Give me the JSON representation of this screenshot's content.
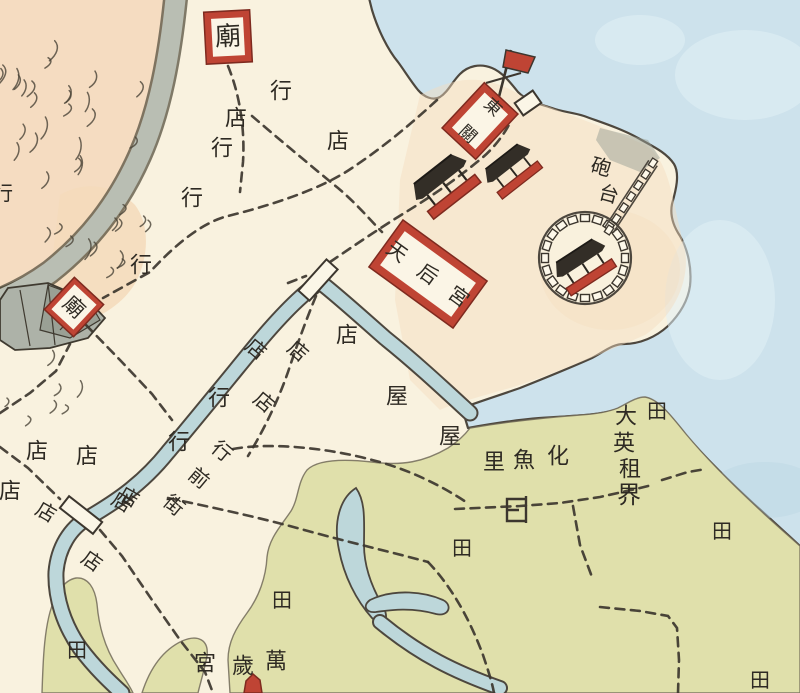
{
  "map": {
    "colors": {
      "paper": "#f9f2df",
      "sea": "#cde2ec",
      "sea_light": "#e2f0f5",
      "river": "#bdd7da",
      "field": "#e0e0ab",
      "hill": "#f5dcc1",
      "hill_soft": "#f3dcbe",
      "gray_band": "#b9beb3",
      "rock": "#adb2a8",
      "red": "#bf4434",
      "red_dark": "#7e2a1f",
      "ink": "#3c362e"
    },
    "place_names": {
      "british_concession": "大英租界",
      "village": "化魚里",
      "street": "行前街",
      "fort": "砲台",
      "tianhou_palace": "天后宮",
      "east_gate": "東關",
      "wansui_palace": "萬歲宮",
      "temple": "廟"
    },
    "red_boxes": [
      {
        "name": "temple-north-box",
        "label": "廟",
        "x": 228,
        "y": 37,
        "w": 46,
        "h": 52,
        "rot": -3,
        "border": 7,
        "font": 26
      },
      {
        "name": "temple-west-box",
        "label": "廟",
        "x": 74,
        "y": 307,
        "w": 40,
        "h": 44,
        "rot": 43,
        "border": 5,
        "font": 21
      },
      {
        "name": "east-gate-box",
        "label": "東關",
        "x": 480,
        "y": 121,
        "w": 46,
        "h": 62,
        "rot": 43,
        "border": 7,
        "font": 17
      },
      {
        "name": "tianhou-palace-box",
        "label": "天后宮",
        "x": 428,
        "y": 274,
        "w": 104,
        "h": 58,
        "rot": 36,
        "border": 8,
        "font": 20
      }
    ],
    "labels": [
      {
        "t": "行",
        "x": 281,
        "y": 92,
        "r": 0,
        "s": 22
      },
      {
        "t": "店",
        "x": 236,
        "y": 119,
        "r": 0,
        "s": 22
      },
      {
        "t": "行",
        "x": 222,
        "y": 149,
        "r": 0,
        "s": 22
      },
      {
        "t": "店",
        "x": 338,
        "y": 142,
        "r": 0,
        "s": 22
      },
      {
        "t": "行",
        "x": 192,
        "y": 199,
        "r": 0,
        "s": 22
      },
      {
        "t": "行",
        "x": 141,
        "y": 266,
        "r": 0,
        "s": 22
      },
      {
        "t": "行",
        "x": 3,
        "y": 193,
        "r": 0,
        "s": 20
      },
      {
        "t": "砲",
        "x": 601,
        "y": 167,
        "r": 15,
        "s": 20
      },
      {
        "t": "台",
        "x": 609,
        "y": 194,
        "r": 15,
        "s": 20
      },
      {
        "t": "店",
        "x": 256,
        "y": 349,
        "r": 40,
        "s": 20
      },
      {
        "t": "店",
        "x": 298,
        "y": 351,
        "r": 40,
        "s": 20
      },
      {
        "t": "店",
        "x": 347,
        "y": 336,
        "r": 0,
        "s": 22
      },
      {
        "t": "店",
        "x": 264,
        "y": 402,
        "r": 40,
        "s": 20
      },
      {
        "t": "行",
        "x": 219,
        "y": 399,
        "r": 0,
        "s": 22
      },
      {
        "t": "屋",
        "x": 397,
        "y": 397,
        "r": 0,
        "s": 22
      },
      {
        "t": "屋",
        "x": 450,
        "y": 437,
        "r": 0,
        "s": 22
      },
      {
        "t": "行",
        "x": 179,
        "y": 443,
        "r": 0,
        "s": 22
      },
      {
        "t": "行",
        "x": 222,
        "y": 451,
        "r": 40,
        "s": 20
      },
      {
        "t": "前",
        "x": 199,
        "y": 478,
        "r": 40,
        "s": 20
      },
      {
        "t": "街",
        "x": 174,
        "y": 505,
        "r": 40,
        "s": 20
      },
      {
        "t": "店",
        "x": 129,
        "y": 497,
        "r": 30,
        "s": 20
      },
      {
        "t": "店",
        "x": 37,
        "y": 452,
        "r": 0,
        "s": 22
      },
      {
        "t": "店",
        "x": 10,
        "y": 492,
        "r": 0,
        "s": 22
      },
      {
        "t": "店",
        "x": 46,
        "y": 512,
        "r": 30,
        "s": 20
      },
      {
        "t": "店",
        "x": 87,
        "y": 457,
        "r": 0,
        "s": 22
      },
      {
        "t": "店",
        "x": 122,
        "y": 502,
        "r": 30,
        "s": 20
      },
      {
        "t": "店",
        "x": 92,
        "y": 561,
        "r": 35,
        "s": 20
      },
      {
        "t": "化",
        "x": 558,
        "y": 457,
        "r": 0,
        "s": 22
      },
      {
        "t": "魚",
        "x": 524,
        "y": 461,
        "r": 0,
        "s": 22
      },
      {
        "t": "里",
        "x": 494,
        "y": 463,
        "r": 0,
        "s": 22
      },
      {
        "t": "大",
        "x": 626,
        "y": 417,
        "r": 0,
        "s": 22
      },
      {
        "t": "英",
        "x": 624,
        "y": 444,
        "r": 0,
        "s": 22
      },
      {
        "t": "租",
        "x": 630,
        "y": 470,
        "r": 0,
        "s": 22
      },
      {
        "t": "界",
        "x": 629,
        "y": 495,
        "r": 0,
        "s": 24
      },
      {
        "t": "田",
        "x": 657,
        "y": 411,
        "r": 0,
        "s": 20
      },
      {
        "t": "田",
        "x": 722,
        "y": 531,
        "r": 0,
        "s": 20
      },
      {
        "t": "田",
        "x": 760,
        "y": 680,
        "r": 0,
        "s": 20
      },
      {
        "t": "田",
        "x": 462,
        "y": 548,
        "r": 0,
        "s": 20
      },
      {
        "t": "田",
        "x": 282,
        "y": 600,
        "r": 0,
        "s": 20
      },
      {
        "t": "田",
        "x": 77,
        "y": 650,
        "r": 0,
        "s": 20
      },
      {
        "t": "宮",
        "x": 205,
        "y": 664,
        "r": 0,
        "s": 22
      },
      {
        "t": "歲",
        "x": 243,
        "y": 667,
        "r": 0,
        "s": 22
      },
      {
        "t": "萬",
        "x": 276,
        "y": 662,
        "r": 0,
        "s": 22
      }
    ]
  }
}
